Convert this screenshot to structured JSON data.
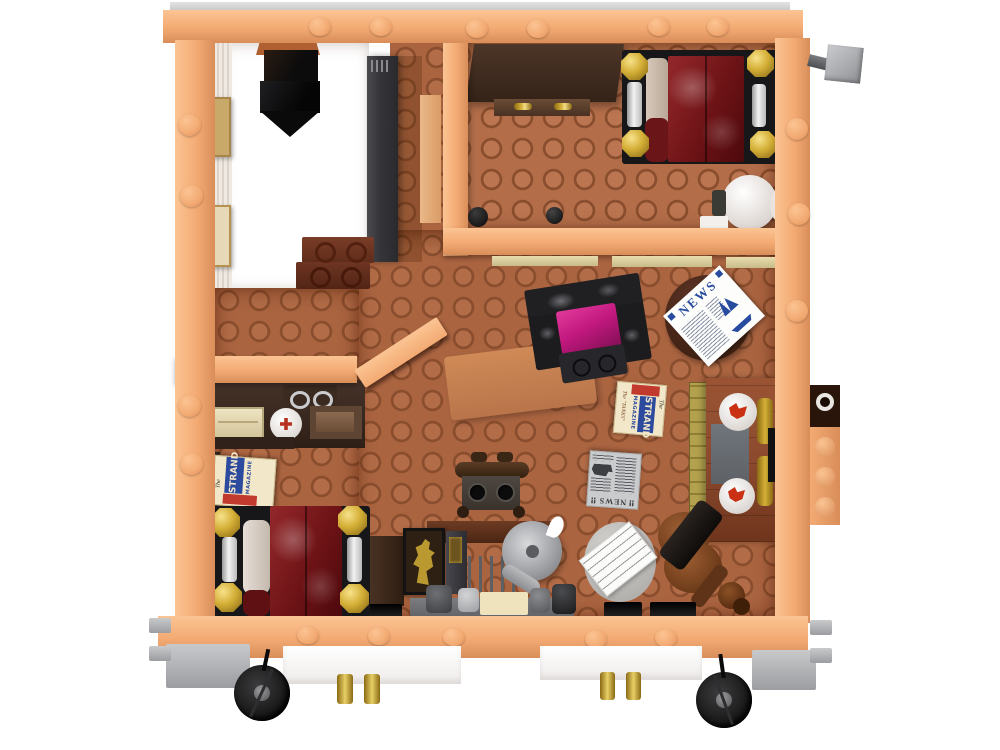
{
  "scene": {
    "subject": "lego-apartment-floorplan-top-view",
    "rooms": [
      "stairwell",
      "bedroom-top",
      "living-room",
      "bedroom-bottom"
    ],
    "items": [
      "four-poster-bed",
      "four-poster-bed",
      "wardrobe",
      "round-table",
      "armchair",
      "side-table-with-newspaper",
      "fireplace",
      "brass-fender",
      "violin",
      "sheet-music",
      "gramophone-desk",
      "desk-chair",
      "silhouette-painting",
      "shelf-unit",
      "magazine-stack",
      "wagon-wheel",
      "wagon-wheel",
      "black-chute"
    ]
  },
  "texts": {
    "news_white": {
      "title": "NEWS"
    },
    "news_gray": {
      "title": "NEWS",
      "bang": "‼"
    },
    "strand": {
      "the": "The",
      "title": "STRAND",
      "magazine": "MAGAZINE",
      "side": "The \"TANKS\"",
      "spine": "THE STRAND"
    }
  },
  "colors": {
    "wall": "#f3aa73",
    "wall_hi": "#fbc493",
    "wall_lo": "#d98e59",
    "floor": "#aa6440",
    "floor_hi": "#b26c47",
    "floor_rim": "#8a4e2e",
    "floor_bedroom": "#b36e49",
    "white_room": "#ffffff",
    "slab": "#36363a",
    "dark_brown": "#402d22",
    "brown": "#5d4030",
    "red_brown": "#8c4a2e",
    "blanket": "#6d1316",
    "blanket_hi": "#94282b",
    "gold": "#d4af37",
    "magenta": "#c2187f",
    "chair_black": "#222225",
    "chair_gray": "#77777c",
    "brass": "#b3a14e",
    "slate": "#5e6267",
    "news_blue": "#274b9f",
    "strand_cream": "#f2e7c9",
    "strand_blue": "#2c4a9e",
    "strand_red": "#c23a2e",
    "gray": "#aeb0b3",
    "wheel": "#141414",
    "paper_gray": "#c9cbcd",
    "ink": "#3c3e42"
  }
}
